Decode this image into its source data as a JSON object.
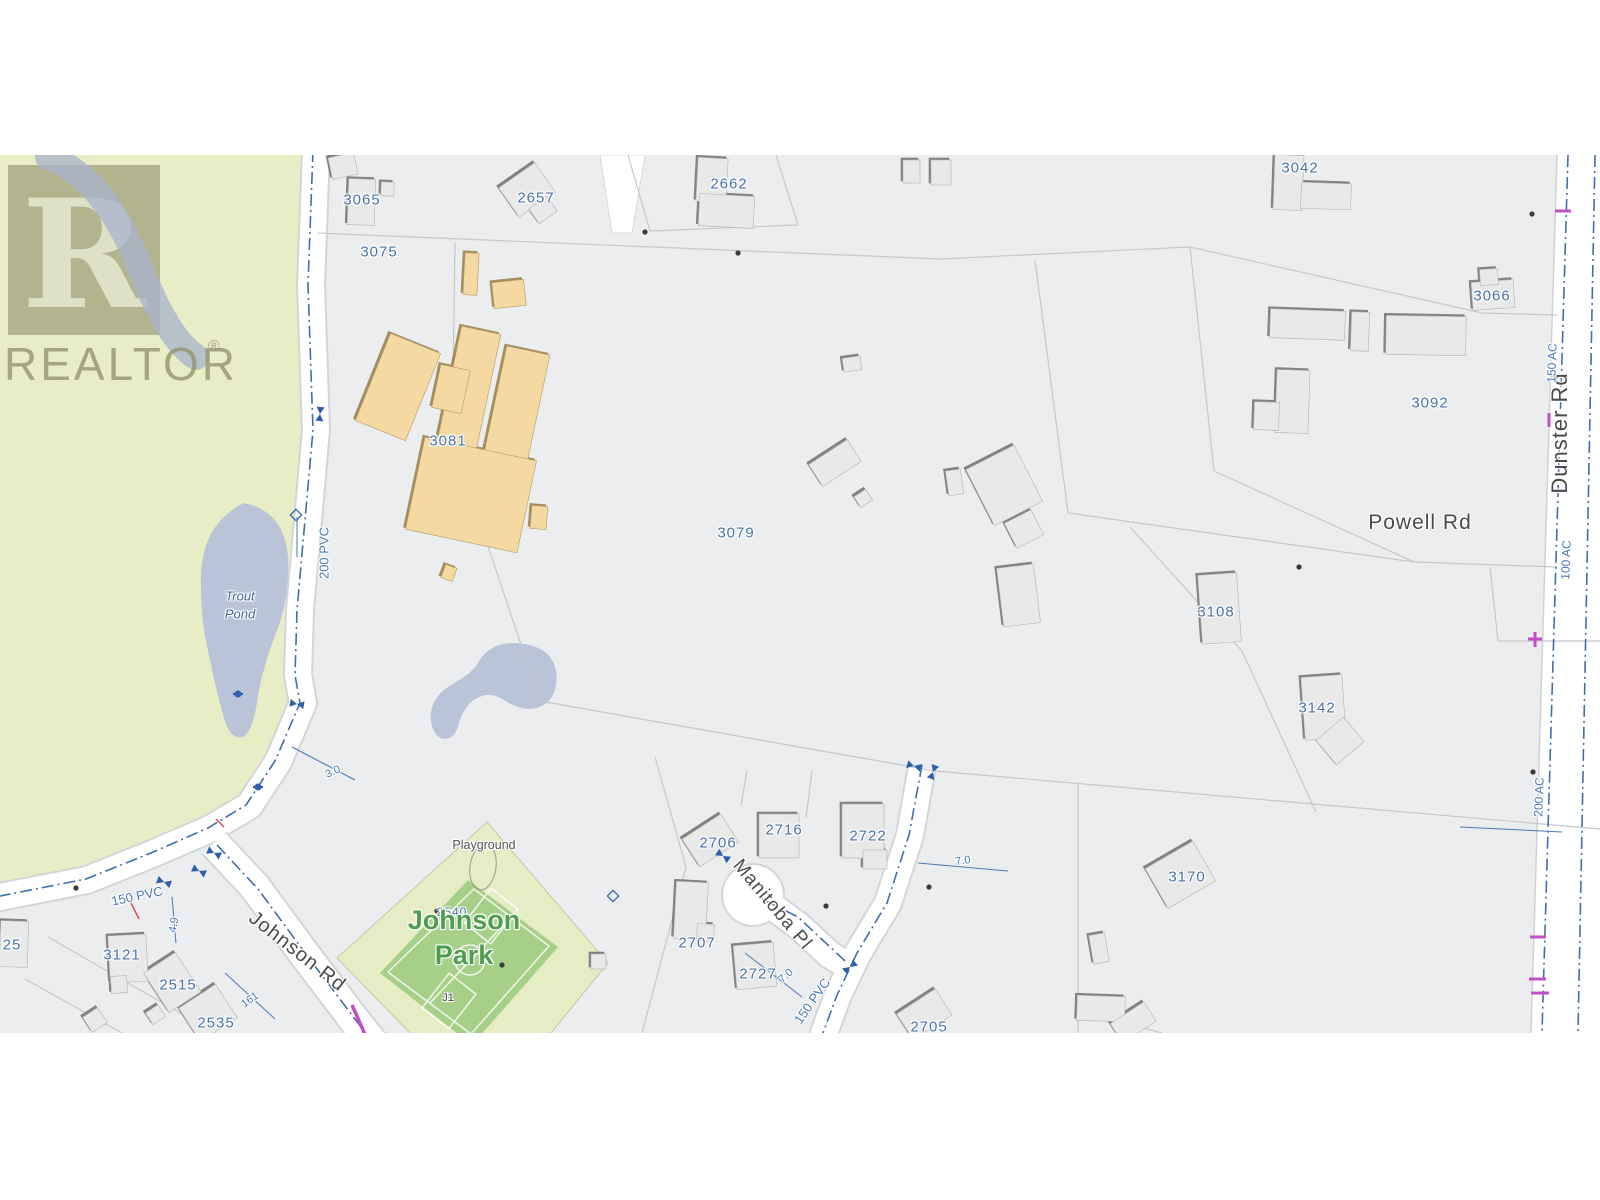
{
  "watermark": {
    "logo_letter": "R",
    "name": "REALTOR",
    "registered": "®"
  },
  "roads": {
    "johnson": "Johnson Rd",
    "manitoba": "Manitoba Pl",
    "powell": "Powell Rd",
    "dunster": "Dunster Rd"
  },
  "places": {
    "park_line1": "Johnson",
    "park_line2": "Park",
    "playground": "Playground",
    "pond_line1": "Trout",
    "pond_line2": "Pond",
    "field_code": "J1"
  },
  "parcels": [
    {
      "id": "3065"
    },
    {
      "id": "3075"
    },
    {
      "id": "2657"
    },
    {
      "id": "2662"
    },
    {
      "id": "3042"
    },
    {
      "id": "3066"
    },
    {
      "id": "3081"
    },
    {
      "id": "3092"
    },
    {
      "id": "3079"
    },
    {
      "id": "3108"
    },
    {
      "id": "3142"
    },
    {
      "id": "3170"
    },
    {
      "id": "2706"
    },
    {
      "id": "2716"
    },
    {
      "id": "2722"
    },
    {
      "id": "2707"
    },
    {
      "id": "2727"
    },
    {
      "id": "2705"
    },
    {
      "id": "2540"
    },
    {
      "id": "2515"
    },
    {
      "id": "2535"
    },
    {
      "id": "3121"
    },
    {
      "id": "25"
    }
  ],
  "utilities": [
    {
      "label": "200 PVC"
    },
    {
      "label": "150 PVC"
    },
    {
      "label": "150 PVC"
    },
    {
      "label": "150 AC"
    },
    {
      "label": "100 AC"
    },
    {
      "label": "200 AC"
    }
  ],
  "measurements": [
    {
      "value": "3.0"
    },
    {
      "value": "7.0"
    },
    {
      "value": "7.0"
    },
    {
      "value": "161"
    },
    {
      "value": "4.9"
    }
  ],
  "colors": {
    "parcel_label": "#4a72a8",
    "pipe_blue": "#3f6db0",
    "road_label": "#4a4a4a",
    "park_green": "#e9edc6",
    "field_green": "#a6cf88",
    "pond_blue": "#b9c4d8",
    "building_gray": "#e9e9e9",
    "school_tan": "#f4d9a2",
    "park_label_green": "#4f9e50",
    "magenta": "#c44fc4",
    "red_tick": "#cc5555"
  }
}
